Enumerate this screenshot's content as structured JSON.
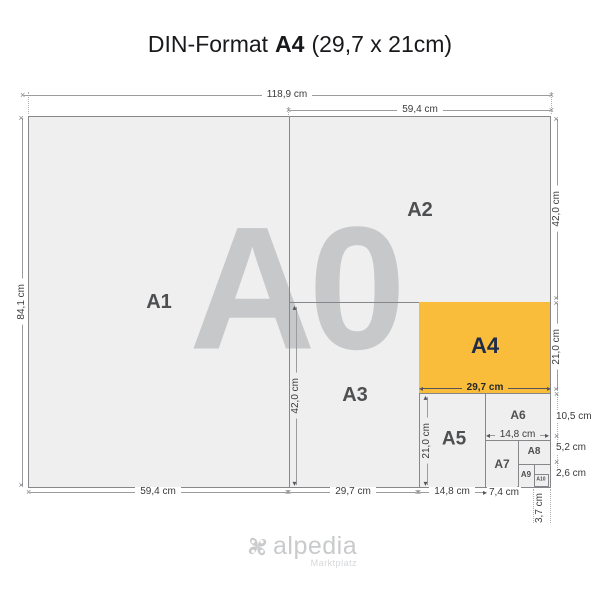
{
  "title": {
    "part1": "DIN-Format",
    "part2": "A4",
    "part3": "(29,7 x 21cm)"
  },
  "papers": {
    "a0": "A0",
    "a1": "A1",
    "a2": "A2",
    "a3": "A3",
    "a4": "A4",
    "a5": "A5",
    "a6": "A6",
    "a7": "A7",
    "a8": "A8",
    "a9": "A9",
    "a10": "A10"
  },
  "dims": {
    "a0_width": "118,9 cm",
    "a2_width_top": "59,4 cm",
    "a0_height": "84,1 cm",
    "a2_height": "42,0 cm",
    "a4_height": "21,0 cm",
    "a6_height": "10,5 cm",
    "a8_height": "5,2 cm",
    "a10_height": "2,6 cm",
    "a1_width_bottom": "59,4 cm",
    "a3_width_bottom": "29,7 cm",
    "a5_width_bottom": "14,8 cm",
    "a7_width_bottom": "7,4 cm",
    "a10_width": "3,7 cm",
    "a3_height_inner": "42,0 cm",
    "a5_height_inner": "21,0 cm",
    "a4_width_inner": "29,7 cm",
    "a6_width_inner": "14,8 cm"
  },
  "icons": {
    "x_marker": "×",
    "arrow_up": "▴",
    "arrow_down": "▾",
    "arrow_left": "◂",
    "arrow_right": "▸"
  },
  "logo": {
    "name": "alpedia",
    "tagline": "Marktplatz"
  },
  "colors": {
    "a4_fill": "#F9BD3B",
    "a4_label": "#1F2B4B",
    "paper_fill": "#EFEFEF",
    "divider_line": "#85878A",
    "dim_line": "#9B9C9E",
    "watermark": "#C7C8C9",
    "paper_label": "#4E4F51",
    "dim_text": "#3A3B3C",
    "title_text": "#17191C",
    "logo_text": "#C8CACC",
    "logo_tagline": "#D5D7D9"
  }
}
